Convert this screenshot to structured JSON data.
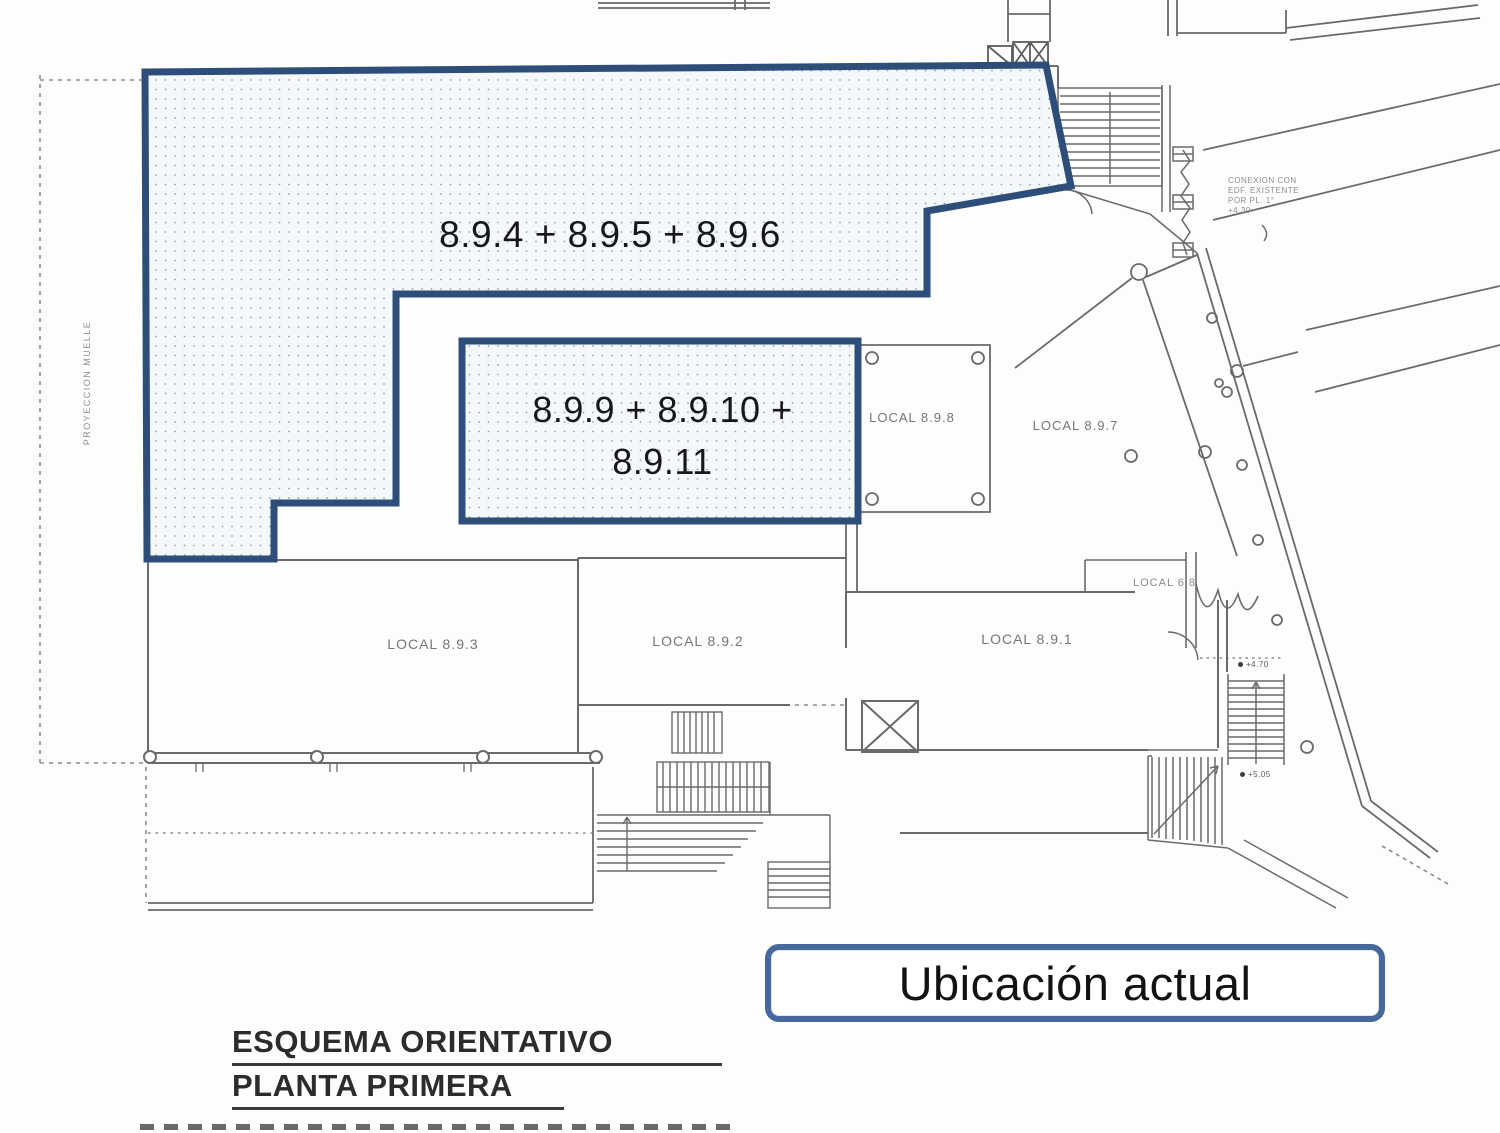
{
  "colors": {
    "highlight_border": "#2d4e79",
    "highlight_fill": "#f5f8fb",
    "highlight_dot": "#93a0b2",
    "callout_border": "#47689a",
    "plan_line": "#6a6a6a",
    "text_dark": "#17171a",
    "text_plan": "#75757d"
  },
  "plan": {
    "region_a_label": "8.9.4 + 8.9.5 + 8.9.6",
    "region_b_line1": "8.9.9 + 8.9.10 +",
    "region_b_line2": "8.9.11",
    "locals": {
      "l898": "LOCAL 8.9.8",
      "l897": "LOCAL 8.9.7",
      "l68": "LOCAL 6.8",
      "l893": "LOCAL 8.9.3",
      "l892": "LOCAL 8.9.2",
      "l891": "LOCAL 8.9.1"
    },
    "levels": {
      "upper": "+4.70",
      "lower": "+5.05"
    },
    "notes": {
      "muelle": "PROYECCION MUELLE",
      "conexion_lines": [
        "CONEXION CON",
        "EDF. EXISTENTE",
        "POR PL. 1°",
        "+4.30"
      ]
    }
  },
  "callout": {
    "label": "Ubicación actual"
  },
  "title": {
    "line1": "ESQUEMA ORIENTATIVO",
    "line2": "PLANTA PRIMERA"
  }
}
